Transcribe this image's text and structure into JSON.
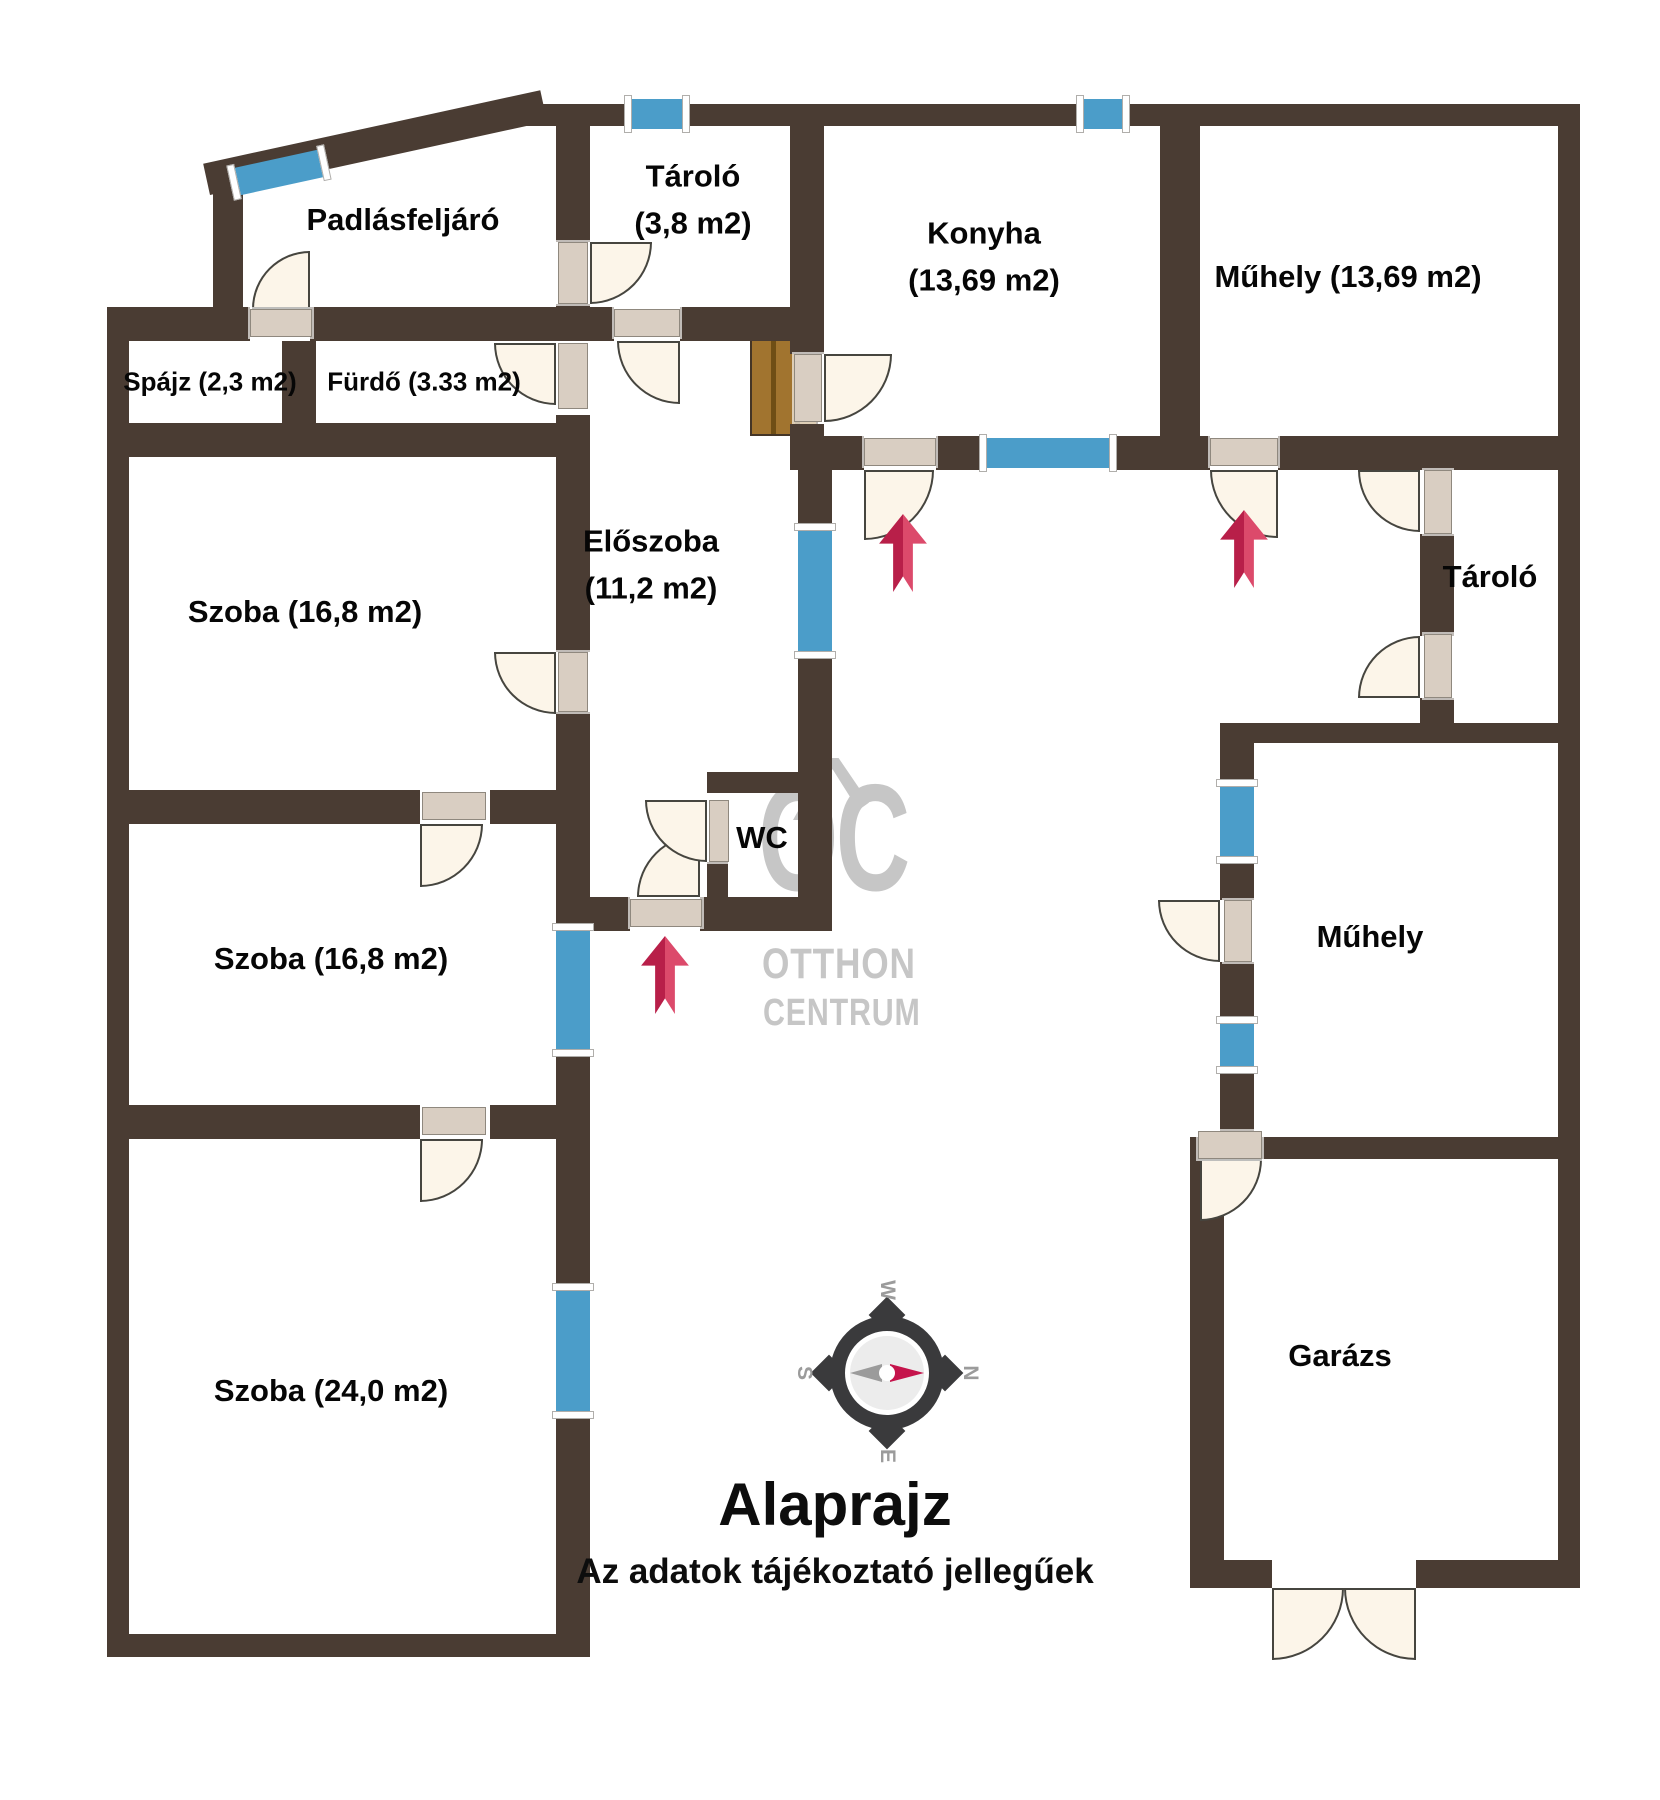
{
  "title": "Alaprajz",
  "subtitle": "Az adatok tájékoztató jellegűek",
  "watermark": {
    "initials": "OC",
    "line1": "OTTHON",
    "line2": "CENTRUM"
  },
  "compass": {
    "top": "W",
    "right": "N",
    "bottom": "E",
    "left": "S"
  },
  "rooms": {
    "padlasfeljaro": {
      "label": "Padlásfeljáró"
    },
    "tarolo_top": {
      "name": "Tároló",
      "area": "(3,8 m2)"
    },
    "konyha": {
      "name": "Konyha",
      "area": "(13,69 m2)"
    },
    "muhely_top": {
      "label": "Műhely (13,69 m2)"
    },
    "spajz": {
      "label": "Spájz (2,3 m2)"
    },
    "furdo": {
      "label": "Fürdő (3.33 m2)"
    },
    "szoba1": {
      "label": "Szoba (16,8 m2)"
    },
    "eloszoba": {
      "name": "Előszoba",
      "area": "(11,2 m2)"
    },
    "szoba2": {
      "label": "Szoba (16,8 m2)"
    },
    "wc": {
      "label": "WC"
    },
    "tarolo_right": {
      "label": "Tároló"
    },
    "muhely_right": {
      "label": "Műhely"
    },
    "szoba3": {
      "label": "Szoba (24,0 m2)"
    },
    "garazs": {
      "label": "Garázs"
    }
  },
  "colors": {
    "wall": "#4a3c33",
    "window": "#4b9dc9",
    "door": "#fcf5e9",
    "entrance_arrow": "#c22048",
    "watermark": "#c6c6c6"
  },
  "icons": {
    "compass_rose": "circular compass, needle pointing right to N",
    "entrance_arrow": "red upward arrow marking entrances"
  }
}
